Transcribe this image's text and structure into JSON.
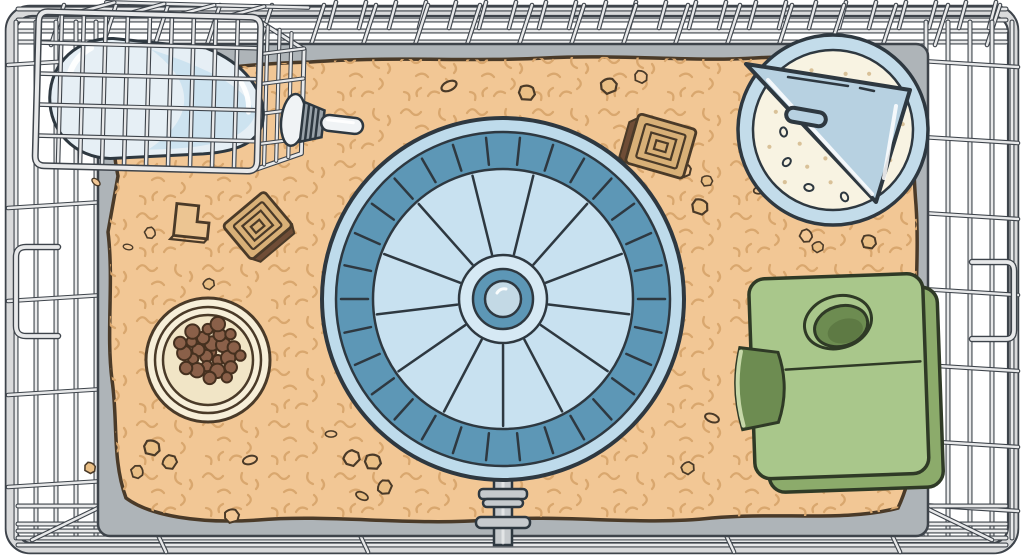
{
  "meta": {
    "title": "Hamster cage - top view illustration",
    "description": "Top-down cartoon illustration of a rectangular wire hamster cage: tan bedding substrate, a large blue exercise wheel on a stand, a water bottle lying in a wire holder at top left with its sipper tube pointing into the cage, a cream food bowl full of brown pellets, a blue corner sand bath with a triangular lid at top right, a green hideout box with a round roof opening and an arched side entrance on the right, plus scattered droppings and wooden chew blocks.",
    "width_px": 1024,
    "height_px": 559
  },
  "palette": {
    "ink": "#2e3840",
    "steel": "#3e444b",
    "inkbrown": "#4a3a28",
    "wire": "#e8e9ea",
    "frame": "#d9dadb",
    "pan": "#aeb4b8",
    "bedding": "#f2c795",
    "squiggle": "#d9a76e",
    "debris": "#eabf85",
    "bowl": "#f7efd9",
    "bowl2": "#f1e5c6",
    "pellet": "#8a6049",
    "pelink": "#45301f",
    "wrim": "#bedbeb",
    "wtread": "#5d97b6",
    "wdisk": "#c8e1f0",
    "whub": "#d6e9f4",
    "wball": "#c3d9e5",
    "stand": "#c6cacd",
    "glass": "#e6eff5",
    "water": "#cde3f0",
    "cap": "#f0f3f5",
    "nozzle": "#98a1a8",
    "bathrim": "#c3dcea",
    "lid": "#b7d1e1",
    "sand": "#f8f3e2",
    "speck": "#d9c198",
    "htop": "#a9c78b",
    "hside": "#8cab6b",
    "hdark": "#6d8c51",
    "hdark2": "#5e7a44",
    "hink": "#2f3a26",
    "hedge": "#c6d8a8",
    "chew": "#d8b077",
    "chewdark": "#6f4d36",
    "lblock": "#ecc592",
    "white": "#ffffff"
  },
  "scene": {
    "type": "illustration",
    "setting": "top-down view of a rectangular wire cage with light gray bars and rounded frame",
    "bedding": {
      "label": "tan bedding substrate with squiggle texture"
    },
    "wheel": {
      "label": "blue exercise wheel on stand",
      "spokes": 13,
      "tread_ticks": 30
    },
    "water_bottle": {
      "label": "water bottle with sipper tube in wire holder"
    },
    "food_bowl": {
      "label": "cream food bowl with pellets",
      "pellets": 26
    },
    "sand_bath": {
      "label": "corner sand bath with triangular lid and handle",
      "speckles": 36
    },
    "hideout": {
      "label": "green hideout box with round roof opening and side entrance"
    },
    "chew_blocks": {
      "label": "wooden chew blocks",
      "count": 3
    },
    "debris": {
      "label": "scattered droppings and bedding bits"
    }
  }
}
